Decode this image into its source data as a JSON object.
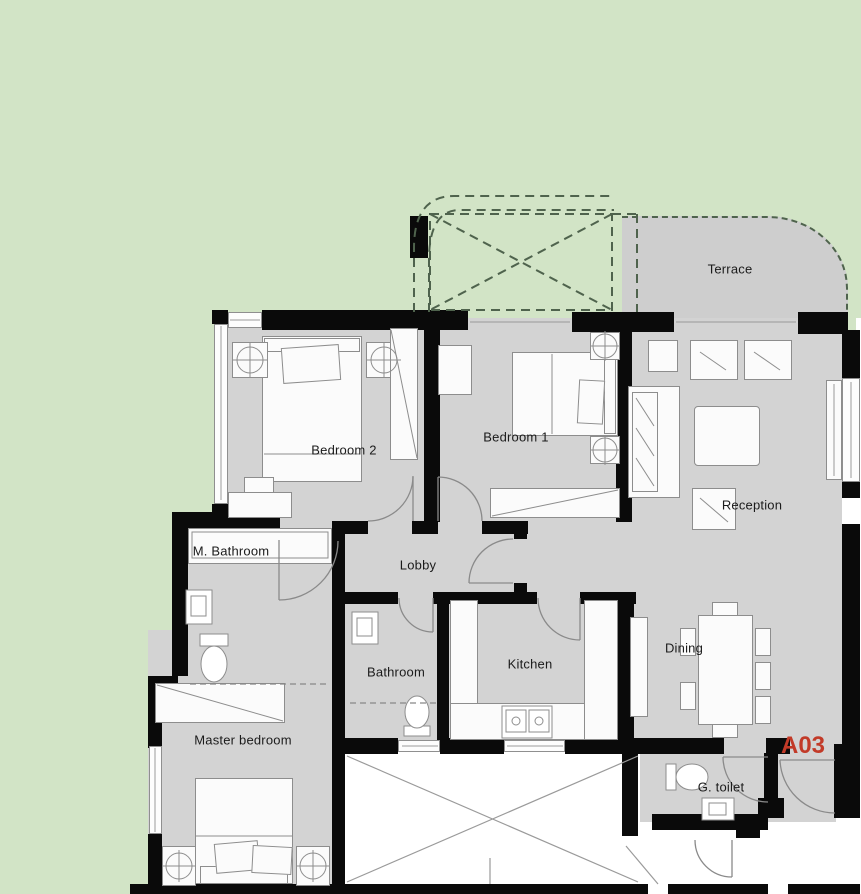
{
  "plan": {
    "unit_label": "A03",
    "rooms": {
      "terrace": "Terrace",
      "bedroom2": "Bedroom 2",
      "bedroom1": "Bedroom 1",
      "reception": "Reception",
      "m_bathroom": "M. Bathroom",
      "lobby": "Lobby",
      "bathroom": "Bathroom",
      "kitchen": "Kitchen",
      "dining": "Dining",
      "master_bedroom": "Master bedroom",
      "g_toilet": "G. toilet"
    },
    "colors": {
      "background_green": "#d2e4c6",
      "floor_gray": "#d3d3d3",
      "wall_black": "#0a0a0a",
      "unit_label_red": "#c23a28",
      "pergola_dashed_line": "#4f634d"
    }
  }
}
